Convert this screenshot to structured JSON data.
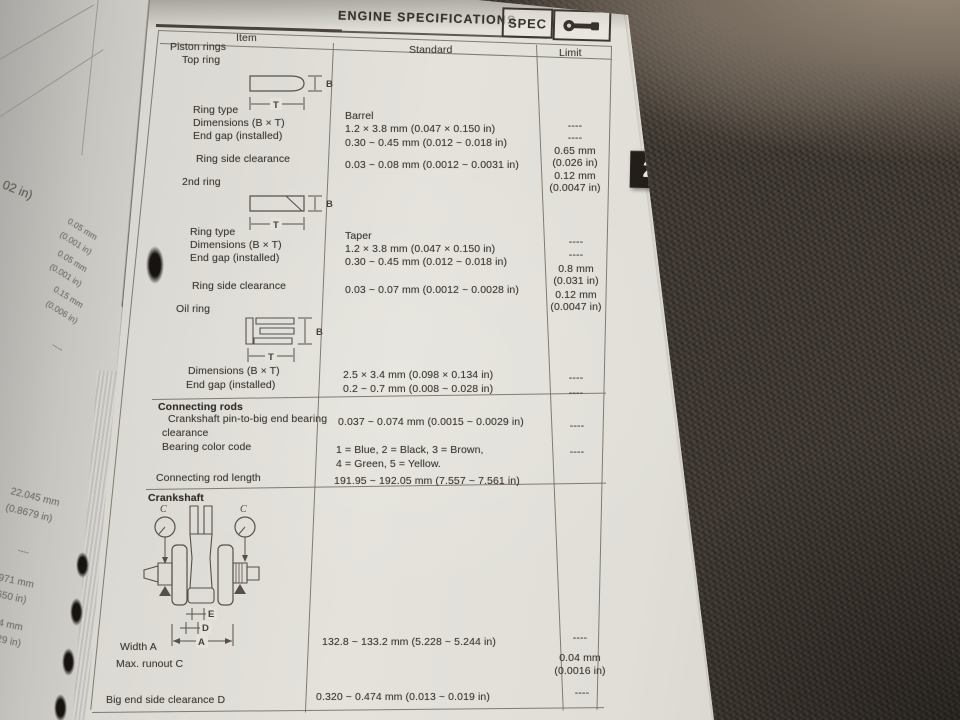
{
  "header": {
    "title": "ENGINE SPECIFICATIONS",
    "spec_label": "SPEC",
    "tab_number": "2"
  },
  "columns": {
    "item": "Item",
    "standard": "Standard",
    "limit": "Limit"
  },
  "piston": {
    "title": "Piston rings",
    "top_ring": {
      "label": "Top ring",
      "type_label": "Ring type",
      "type": "Barrel",
      "type_lim": "----",
      "dim_label": "Dimensions (B × T)",
      "dim": "1.2 × 3.8 mm (0.047 × 0.150 in)",
      "dim_lim": "----",
      "gap_label": "End gap (installed)",
      "gap": "0.30 ~ 0.45 mm (0.012 ~ 0.018 in)",
      "gap_lim1": "0.65 mm",
      "gap_lim2": "(0.026 in)",
      "side_label": "Ring side clearance",
      "side": "0.03 ~ 0.08 mm (0.0012 ~ 0.0031 in)",
      "side_lim1": "0.12 mm",
      "side_lim2": "(0.0047 in)"
    },
    "second_ring": {
      "label": "2nd ring",
      "type_label": "Ring type",
      "type": "Taper",
      "type_lim": "----",
      "dim_label": "Dimensions (B × T)",
      "dim": "1.2 × 3.8 mm (0.047 × 0.150 in)",
      "dim_lim": "----",
      "gap_label": "End gap (installed)",
      "gap": "0.30 ~ 0.45 mm (0.012 ~ 0.018 in)",
      "gap_lim1": "0.8 mm",
      "gap_lim2": "(0.031 in)",
      "side_label": "Ring side clearance",
      "side": "0.03 ~ 0.07 mm (0.0012 ~ 0.0028 in)",
      "side_lim1": "0.12 mm",
      "side_lim2": "(0.0047 in)"
    },
    "oil_ring": {
      "label": "Oil ring",
      "dim_label": "Dimensions (B × T)",
      "dim": "2.5 × 3.4 mm (0.098 × 0.134 in)",
      "dim_lim": "----",
      "gap_label": "End gap (installed)",
      "gap": "0.2 ~ 0.7 mm (0.008 ~ 0.028 in)",
      "gap_lim": "----"
    }
  },
  "conrods": {
    "title": "Connecting rods",
    "clearance_label1": "Crankshaft pin-to-big end bearing",
    "clearance_label2": "clearance",
    "clearance": "0.037 ~ 0.074 mm (0.0015 ~ 0.0029 in)",
    "clearance_lim": "----",
    "color_label": "Bearing color code",
    "color1": "1 = Blue, 2 = Black, 3 = Brown,",
    "color2": "4 = Green, 5 = Yellow.",
    "color_lim": "----",
    "length_label": "Connecting rod length",
    "length": "191.95 ~ 192.05 mm (7.557 ~ 7.561 in)"
  },
  "crank": {
    "title": "Crankshaft",
    "width_label": "Width A",
    "width": "132.8 ~ 133.2 mm (5.228 ~ 5.244 in)",
    "width_lim": "----",
    "runout_label": "Max. runout C",
    "runout_lim1": "0.04 mm",
    "runout_lim2": "(0.0016 in)",
    "bigend_label": "Big end side clearance D",
    "bigend": "0.320 ~ 0.474 mm (0.013 ~ 0.019 in)",
    "bigend_lim": "----"
  },
  "diagram_labels": {
    "b": "B",
    "t": "T",
    "c": "C",
    "e": "E",
    "d": "D",
    "a": "A"
  },
  "margin_fragments": {
    "f1": "02 in)",
    "f2": "0.05 mm",
    "f3": "(0.001 in)",
    "f4": "0.05 mm",
    "f5": "(0.001 in)",
    "f6": "0.15 mm",
    "f7": "(0.006 in)",
    "f8": "----",
    "f9": "22.045 mm",
    "f10": "(0.8679 in)",
    "f11": "----",
    "f12": "971 mm",
    "f13": "650 in)",
    "f14": "4 mm",
    "f15": "29 in)"
  }
}
